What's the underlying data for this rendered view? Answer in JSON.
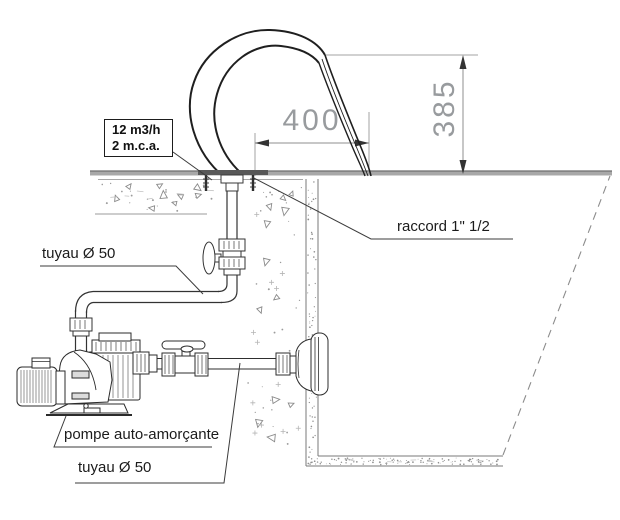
{
  "title": "schema installation cascade piscine",
  "flow_box": {
    "line1": "12 m3/h",
    "line2": "2 m.c.a."
  },
  "labels": {
    "pipe_discharge": "tuyau Ø 50",
    "connector": "raccord 1\" 1/2",
    "pump": "pompe auto-amorçante",
    "pipe_suction": "tuyau Ø 50"
  },
  "dimensions": {
    "jet_width_mm": "400",
    "jet_height_mm": "385"
  },
  "colors": {
    "line_dark": "#2b2b2b",
    "jet_line": "#1f1f1f",
    "dim_gray": "#989b9e",
    "deck_gray": "#a8a8a8",
    "stipple_gray": "#8f8f8f"
  }
}
